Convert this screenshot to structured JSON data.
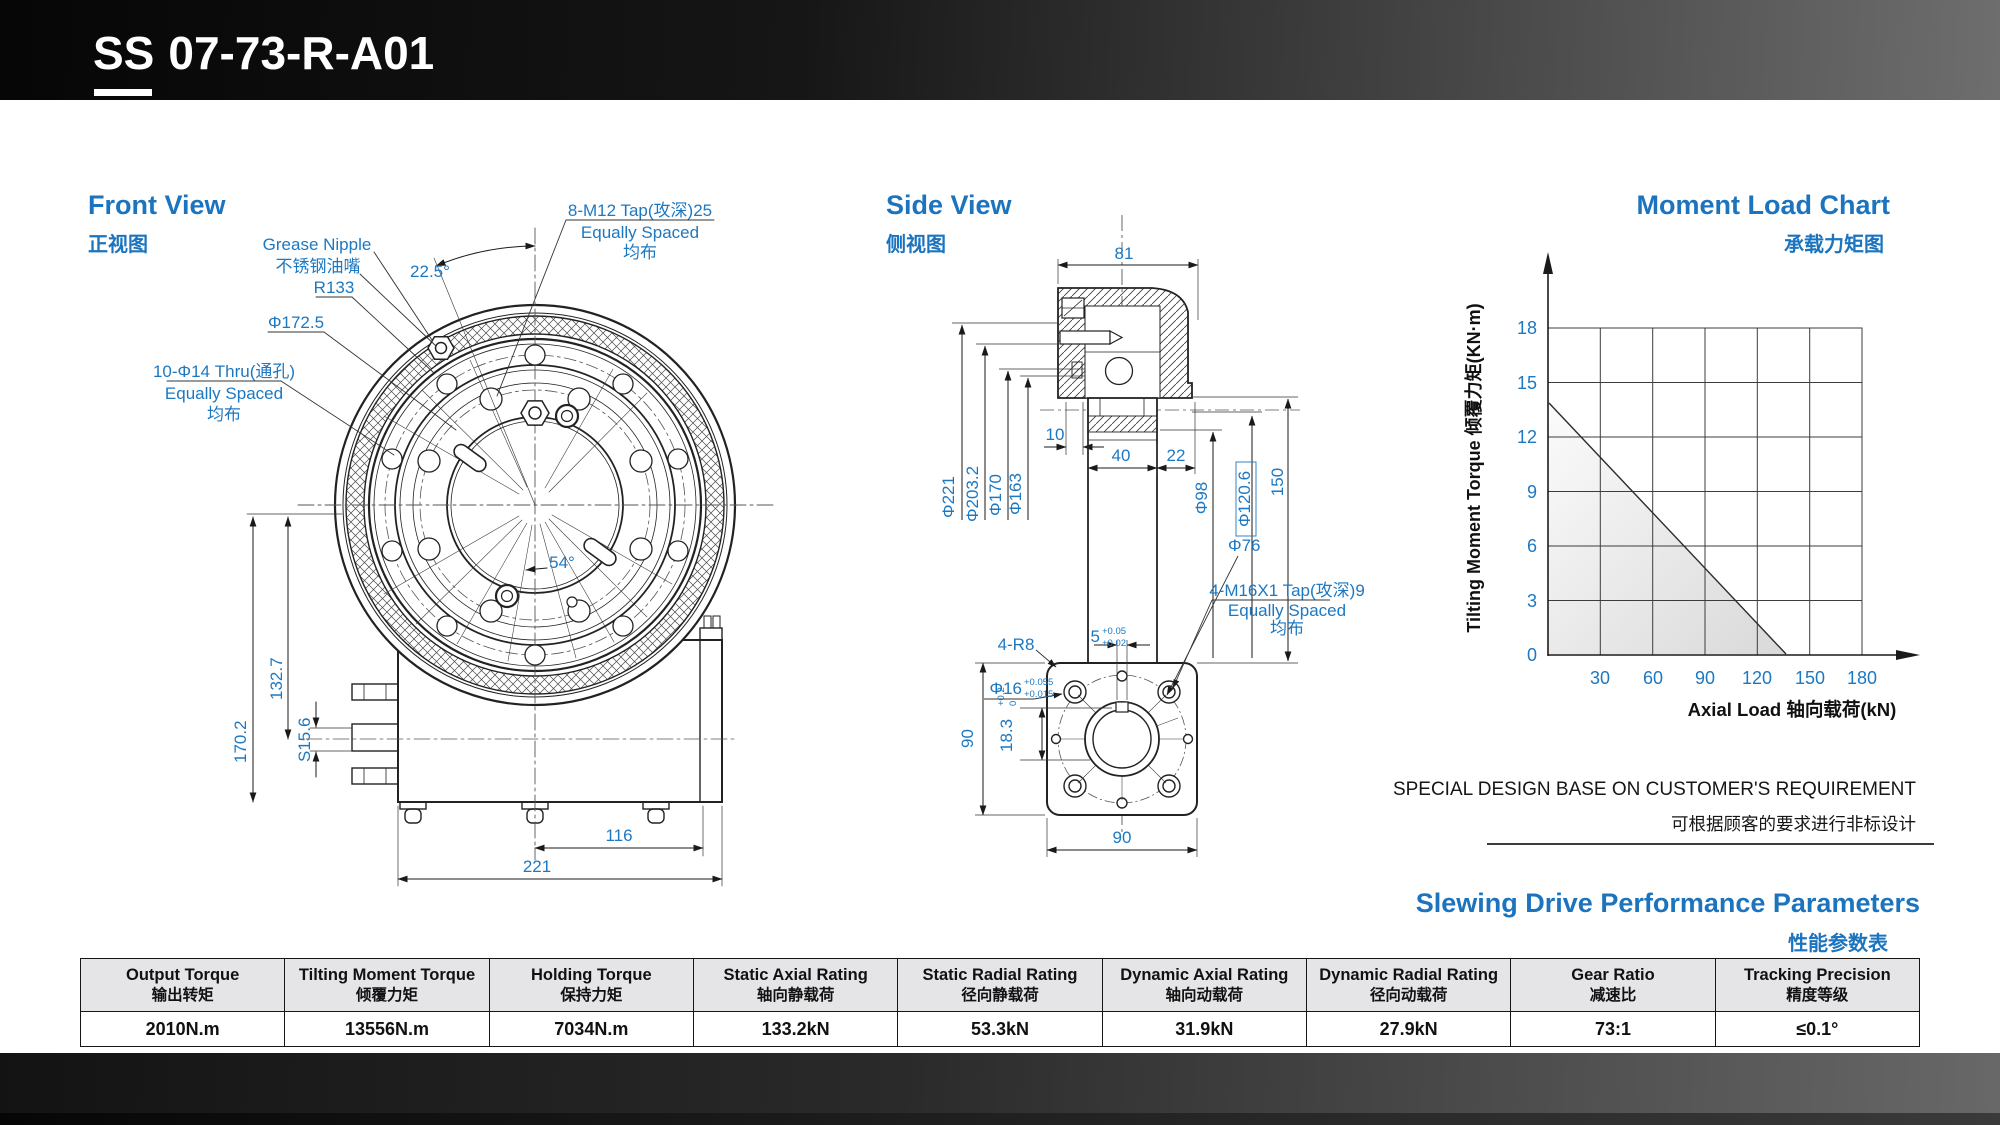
{
  "header": {
    "model_prefix": "SS",
    "model_code": "07-73-R-A01"
  },
  "front_view": {
    "title": "Front View",
    "subtitle": "正视图",
    "labels": {
      "grease_en": "Grease Nipple",
      "grease_zh": "不锈钢油嘴",
      "r133": "R133",
      "d1725": "Φ172.5",
      "ang225": "22.5°",
      "ang54": "54°",
      "m12_l1": "8-M12  Tap(攻深)25",
      "m12_l2": "Equally Spaced",
      "m12_l3": "均布",
      "d14_l1": "10-Φ14 Thru(通孔)",
      "d14_l2": "Equally Spaced",
      "d14_l3": "均布",
      "dim170": "170.2",
      "dim132": "132.7",
      "dim156": "S15.6",
      "dim116": "116",
      "dim221": "221"
    }
  },
  "side_view": {
    "title": "Side View",
    "subtitle": "侧视图",
    "labels": {
      "dim81": "81",
      "dim10": "10",
      "dim40": "40",
      "dim22": "22",
      "d221": "Φ221",
      "d203": "Φ203.2",
      "d170": "Φ170",
      "d163": "Φ163",
      "d98": "Φ98",
      "d120": "Φ120.6",
      "dim150": "150",
      "r8": "4-R8",
      "key5": "5",
      "key5_tol_top": "+0.05",
      "key5_tol_bot": "+0.02",
      "d16": "Φ16",
      "d16_tol_top": "+0.055",
      "d16_tol_bot": "+0.015",
      "dim183": "18.3",
      "dim183_tol_top": "+0.2",
      "dim183_tol_bot": "0",
      "d76": "Φ76",
      "m16_l1": "4-M16X1 Tap(攻深)9",
      "m16_l2": "Equally Spaced",
      "m16_l3": "均布",
      "dim90l": "90",
      "dim90b": "90"
    }
  },
  "chart": {
    "title": "Moment Load Chart",
    "subtitle": "承载力矩图",
    "ylabel": "Tilting  Moment  Torque 倾覆力矩(KN·m)",
    "xlabel": "Axial  Load 轴向载荷(kN)",
    "yticks": [
      "18",
      "15",
      "12",
      "9",
      "6",
      "3",
      "0"
    ],
    "xticks": [
      "30",
      "60",
      "90",
      "120",
      "150",
      "180"
    ]
  },
  "chart_data": {
    "type": "line",
    "title": "Moment Load Chart 承载力矩图",
    "xlabel": "Axial Load 轴向载荷(kN)",
    "ylabel": "Tilting Moment Torque 倾覆力矩(KN·m)",
    "x": [
      0,
      135
    ],
    "series": [
      {
        "name": "load-limit-line",
        "values": [
          14,
          0
        ]
      }
    ],
    "xlim": [
      0,
      180
    ],
    "ylim": [
      0,
      18
    ],
    "x_ticks": [
      30,
      60,
      90,
      120,
      150,
      180
    ],
    "y_ticks": [
      0,
      3,
      6,
      9,
      12,
      15,
      18
    ],
    "grid": true,
    "legend": false,
    "shaded_region": "below line"
  },
  "notes": {
    "en": "SPECIAL DESIGN BASE ON CUSTOMER'S REQUIREMENT",
    "zh": "可根据顾客的要求进行非标设计"
  },
  "performance": {
    "title": "Slewing Drive Performance Parameters",
    "subtitle": "性能参数表",
    "columns": [
      {
        "en": "Output Torque",
        "zh": "输出转矩",
        "value": "2010N.m"
      },
      {
        "en": "Tilting Moment Torque",
        "zh": "倾覆力矩",
        "value": "13556N.m"
      },
      {
        "en": "Holding Torque",
        "zh": "保持力矩",
        "value": "7034N.m"
      },
      {
        "en": "Static Axial Rating",
        "zh": "轴向静载荷",
        "value": "133.2kN"
      },
      {
        "en": "Static Radial Rating",
        "zh": "径向静载荷",
        "value": "53.3kN"
      },
      {
        "en": "Dynamic Axial Rating",
        "zh": "轴向动载荷",
        "value": "31.9kN"
      },
      {
        "en": "Dynamic Radial Rating",
        "zh": "径向动载荷",
        "value": "27.9kN"
      },
      {
        "en": "Gear Ratio",
        "zh": "减速比",
        "value": "73:1"
      },
      {
        "en": "Tracking Precision",
        "zh": "精度等级",
        "value": "≤0.1°"
      }
    ]
  },
  "accent_color": "#1b74bd",
  "dim_color": "#1d78c2"
}
